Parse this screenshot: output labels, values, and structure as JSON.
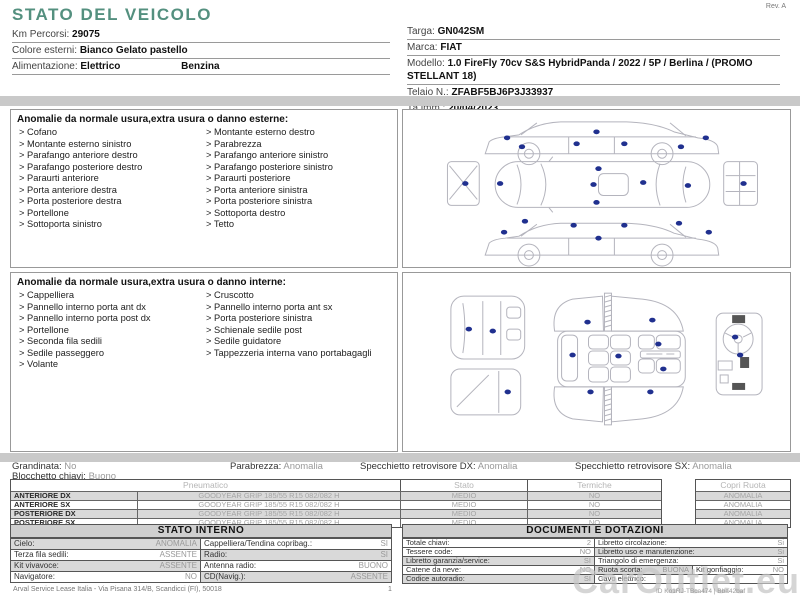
{
  "title": "STATO DEL VEICOLO",
  "rev": "Rev. A",
  "info_left": [
    {
      "label": "Km Percorsi:",
      "value": "29075"
    },
    {
      "label": "Colore esterni:",
      "value": "Bianco Gelato pastello"
    },
    {
      "label": "Alimentazione:",
      "value": "Elettrico",
      "value2": "Benzina"
    }
  ],
  "info_right": [
    {
      "label": "Targa:",
      "value": "GN042SM"
    },
    {
      "label": "Marca:",
      "value": "FIAT"
    },
    {
      "label": "Modello:",
      "value": "1.0 FireFly 70cv S&S HybridPanda / 2022 / 5P / Berlina  / (PROMO STELLANT 18)"
    },
    {
      "label": "Telaio N.:",
      "value": "ZFABF5BJ6P3J33937"
    },
    {
      "label": "1a imm.:",
      "value": "20/04/2023"
    }
  ],
  "exterior": {
    "title": "Anomalie da normale usura,extra usura o danno esterne:",
    "col1": [
      "Cofano",
      "Montante esterno sinistro",
      "Parafango anteriore destro",
      "Parafango posteriore destro",
      "Paraurti anteriore",
      "Porta anteriore destra",
      "Porta posteriore destra",
      "Portellone",
      "Sottoporta sinistro"
    ],
    "col2": [
      "Montante esterno destro",
      "Parabrezza",
      "Parafango anteriore sinistro",
      "Parafango posteriore sinistro",
      "Paraurti posteriore",
      "Porta anteriore sinistra",
      "Porta posteriore sinistra",
      "Sottoporta destro",
      "Tetto"
    ]
  },
  "interior": {
    "title": "Anomalie da normale usura,extra usura o danno interne:",
    "col1": [
      "Cappelliera",
      "Pannello interno porta ant dx",
      "Pannello interno porta post dx",
      "Portellone",
      "Seconda fila sedili",
      "Sedile passeggero",
      "Volante"
    ],
    "col2": [
      "Cruscotto",
      "Pannello interno porta ant sx",
      "Porta posteriore sinistra",
      "Schienale sedile post",
      "Sedile guidatore",
      "Tappezzeria interna vano portabagagli"
    ]
  },
  "status": [
    {
      "label": "Grandinata:",
      "value": "No"
    },
    {
      "label": "Blocchetto chiavi:",
      "value": "Buono"
    },
    {
      "label": "Parabrezza:",
      "value": "Anomalia"
    },
    {
      "label": "Specchietto retrovisore DX:",
      "value": "Anomalia"
    },
    {
      "label": "Specchietto retrovisore SX:",
      "value": "Anomalia"
    }
  ],
  "tires": {
    "header_pneumatico": "Pneumatico",
    "header_stato": "Stato",
    "header_termiche": "Termiche",
    "header_copri": "Copri Ruota",
    "rows": [
      {
        "pos": "ANTERIORE DX",
        "tire": "GOODYEAR GRIP 185/55 R15 082/082 H",
        "stato": "MEDIO",
        "termiche": "NO",
        "copri": "ANOMALIA"
      },
      {
        "pos": "ANTERIORE SX",
        "tire": "GOODYEAR GRIP 185/55 R15 082/082 H",
        "stato": "MEDIO",
        "termiche": "NO",
        "copri": "ANOMALIA"
      },
      {
        "pos": "POSTERIORE DX",
        "tire": "GOODYEAR GRIP 185/55 R15 082/082 H",
        "stato": "MEDIO",
        "termiche": "NO",
        "copri": "ANOMALIA"
      },
      {
        "pos": "POSTERIORE SX",
        "tire": "GOODYEAR GRIP 185/55 R15 082/082 H",
        "stato": "MEDIO",
        "termiche": "NO",
        "copri": "ANOMALIA"
      }
    ]
  },
  "stato_interno": {
    "title": "STATO INTERNO",
    "rows": [
      {
        "l1": "Cielo:",
        "v1": "ANOMALIA",
        "l2": "Cappelliera/Tendina copribag.:",
        "v2": "SI"
      },
      {
        "l1": "Terza fila sedili:",
        "v1": "ASSENTE",
        "l2": "Radio:",
        "v2": "SI"
      },
      {
        "l1": "Kit vivavoce:",
        "v1": "ASSENTE",
        "l2": "Antenna radio:",
        "v2": "BUONO"
      },
      {
        "l1": "Navigatore:",
        "v1": "NO",
        "l2": "CD(Navig.):",
        "v2": "ASSENTE"
      }
    ]
  },
  "documenti": {
    "title": "DOCUMENTI E DOTAZIONI",
    "rows": [
      {
        "l1": "Totale chiavi:",
        "v1": "2",
        "l2": "Libretto circolazione:",
        "v2": "Si"
      },
      {
        "l1": "Tessere code:",
        "v1": "NO",
        "l2": "Libretto uso e manutenzione:",
        "v2": "Si"
      },
      {
        "l1": "Libretto garanzia/service:",
        "v1": "SI",
        "l2": "Triangolo di emergenza:",
        "v2": "Si"
      },
      {
        "l1": "Catene da neve:",
        "v1": "NO",
        "l2": "Ruota scorta:",
        "v2": "BUONA",
        "l3": "Kit gonfiaggio:",
        "v3": "NO"
      },
      {
        "l1": "Codice autoradio:",
        "v1": "SI",
        "l2": "Cavo elettrico:",
        "v2": ""
      }
    ]
  },
  "footer": {
    "company": "Arval Service Lease Italia - Via Pisana 314/B, Scandicci (FI), 50018",
    "page": "1",
    "watermark": "CarOutlet.eu",
    "doc_id": "ID Ko1RJ-TBca474 | Bba42baf"
  },
  "diagrams": {
    "marker_color": "#20308f",
    "exterior_markers": [
      [
        104,
        28
      ],
      [
        119,
        37
      ],
      [
        174,
        34
      ],
      [
        194,
        22
      ],
      [
        222,
        34
      ],
      [
        279,
        37
      ],
      [
        304,
        28
      ],
      [
        62,
        74
      ],
      [
        97,
        74
      ],
      [
        191,
        75
      ],
      [
        241,
        73
      ],
      [
        286,
        76
      ],
      [
        342,
        74
      ],
      [
        196,
        59
      ],
      [
        194,
        93
      ],
      [
        101,
        123
      ],
      [
        122,
        112
      ],
      [
        171,
        116
      ],
      [
        196,
        129
      ],
      [
        222,
        116
      ],
      [
        277,
        114
      ],
      [
        307,
        123
      ]
    ],
    "interior_markers": [
      [
        66,
        56
      ],
      [
        90,
        58
      ],
      [
        105,
        119
      ],
      [
        185,
        49
      ],
      [
        250,
        47
      ],
      [
        256,
        71
      ],
      [
        170,
        82
      ],
      [
        216,
        83
      ],
      [
        261,
        96
      ],
      [
        188,
        119
      ],
      [
        248,
        119
      ],
      [
        333,
        64
      ],
      [
        338,
        82
      ]
    ]
  }
}
